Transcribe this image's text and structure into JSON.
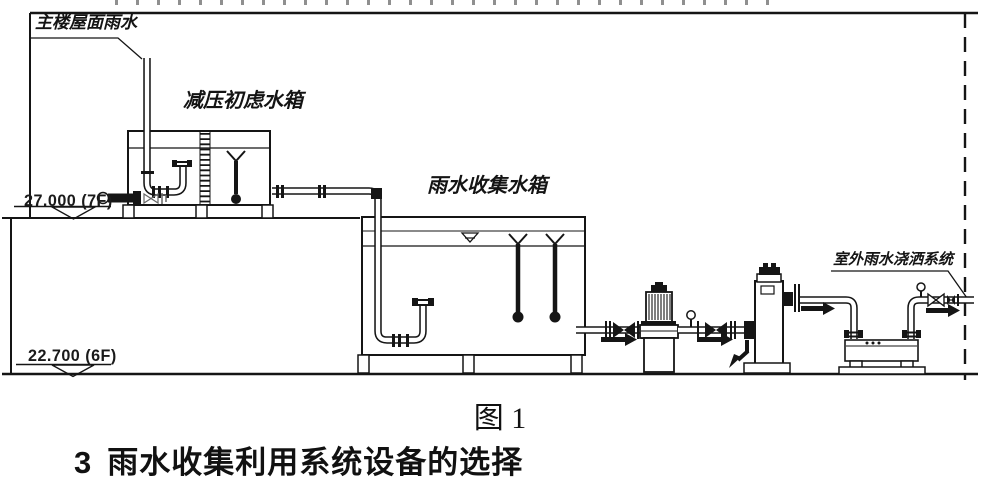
{
  "figure_labels": {
    "roof_rainwater": "主楼屋面雨水",
    "pressure_reducing_filter_tank": "减压初虑水箱",
    "rainwater_collection_tank": "雨水收集水箱",
    "outdoor_spray_system": "室外雨水浇洒系统"
  },
  "elevation_markers": [
    {
      "value": "27.000",
      "floor": "(7F)"
    },
    {
      "value": "22.700",
      "floor": "(6F)"
    }
  ],
  "caption": "图 1",
  "heading": {
    "number": "3",
    "title": "雨水收集利用系统设备的选择"
  },
  "colors": {
    "line": "#151515",
    "background": "#ffffff"
  }
}
